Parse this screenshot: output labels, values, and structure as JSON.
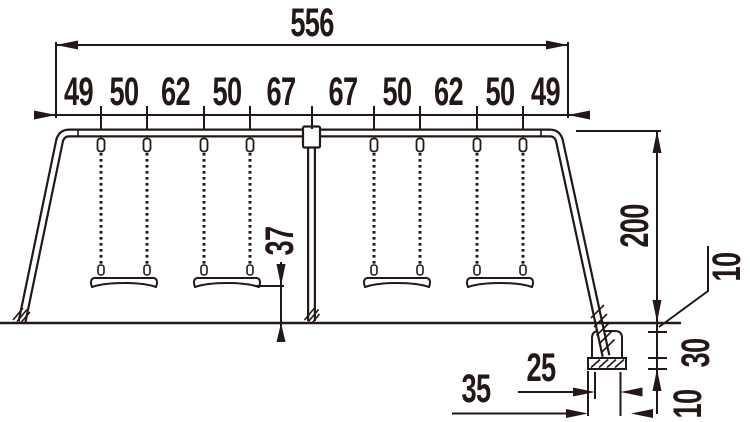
{
  "drawing": {
    "type": "technical-dimension-drawing",
    "subject": "four-seat swing set elevation",
    "unit_note": "",
    "ink_color": "#231815",
    "dims": {
      "total_width": "556",
      "segments": [
        "49",
        "50",
        "62",
        "50",
        "67",
        "67",
        "50",
        "62",
        "50",
        "49"
      ],
      "frame_height": "200",
      "seat_to_ground": "37",
      "ground_to_footing_top": "10",
      "footing_block_depth": "30",
      "footing_base_depth": "10",
      "footing_block_width": "25",
      "footing_base_width": "35"
    }
  }
}
